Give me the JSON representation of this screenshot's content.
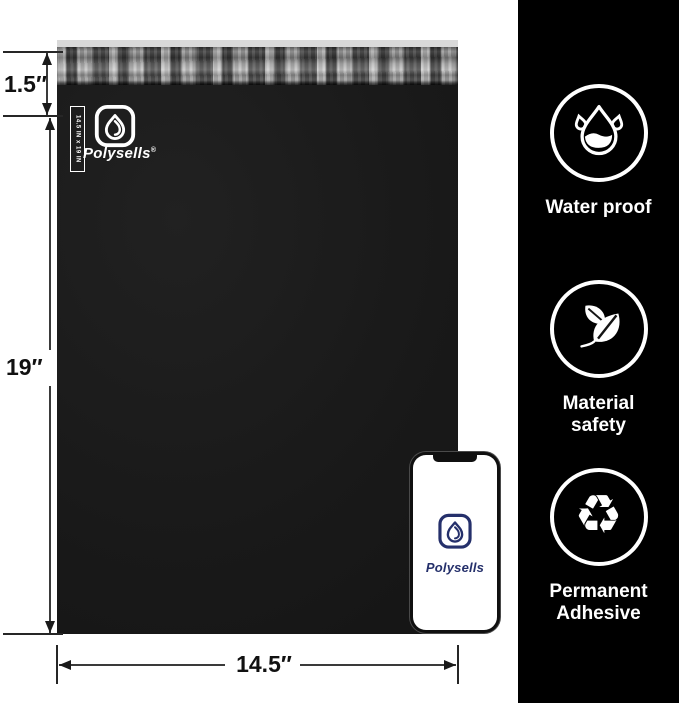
{
  "product": {
    "brand": "Polysells",
    "registered_mark": "®",
    "size_strip_label": "14.5 IN x 19 IN"
  },
  "dimensions": {
    "flap": "1.5″",
    "height": "19″",
    "width": "14.5″"
  },
  "phone": {
    "brand": "Polysells"
  },
  "features": [
    {
      "label": "Water proof",
      "icon": "water-drop-icon"
    },
    {
      "label": "Material safety",
      "icon": "leaf-icon"
    },
    {
      "label": "Permanent Adhesive",
      "icon": "recycle-icon"
    }
  ],
  "icons": {
    "recycle_glyph": "♻"
  },
  "colors": {
    "background": "#ffffff",
    "sidebar": "#000000",
    "bag_body": "#1a1a1a",
    "bag_back_strip": "#d9d9d9",
    "brand_navy": "#25306b",
    "annotation": "#1a1a1a"
  }
}
